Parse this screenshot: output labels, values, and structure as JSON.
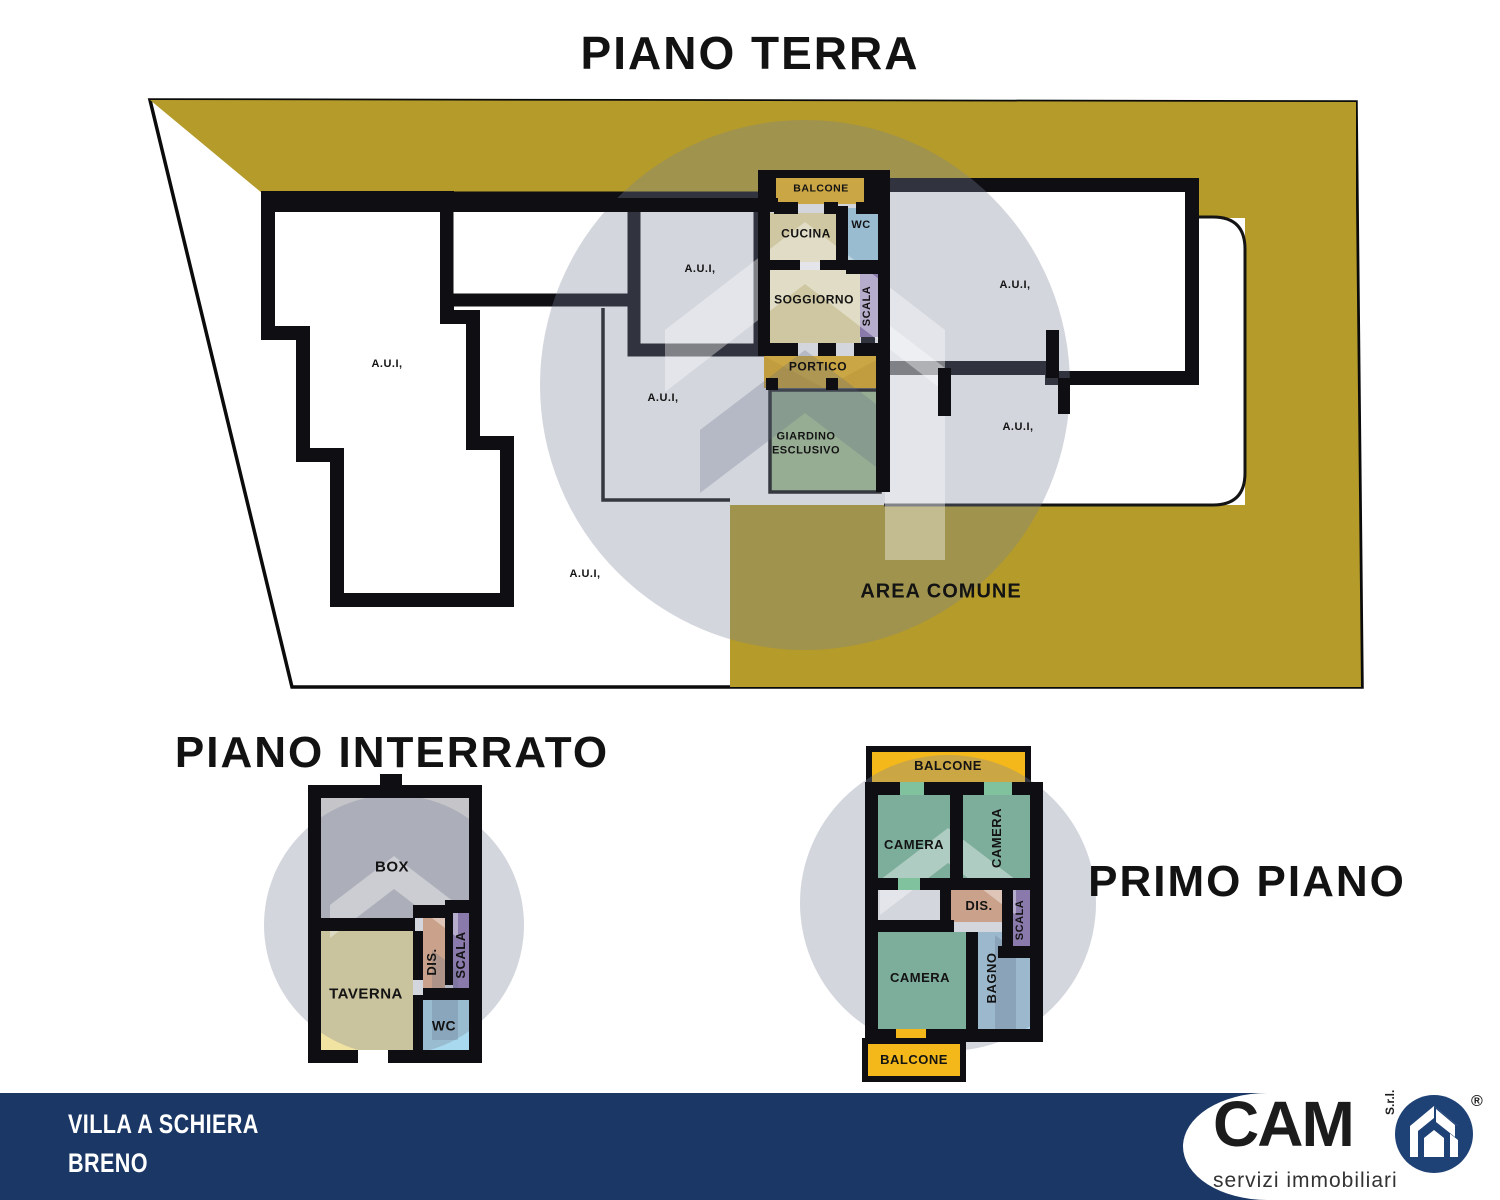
{
  "colors": {
    "gold": "#b49b2a",
    "bright_gold": "#f4b81b",
    "pale_yellow": "#f9e9a7",
    "wc_blue": "#a9d9ee",
    "bagno_blue": "#aed3e8",
    "stair_purple": "#9377b6",
    "garden_green": "#a4c293",
    "camera_green": "#7fc29d",
    "dis_orange": "#f2b285",
    "box_gray": "#c5c5c9",
    "taverna_yellow": "#f1e3a2",
    "wall_black": "#0e0e13",
    "footer_navy": "#1b3765",
    "logo_blue": "#1e4176",
    "watermark_gray": "#7a8399"
  },
  "titles": {
    "ground": "PIANO TERRA",
    "basement": "PIANO INTERRATO",
    "first": "PRIMO PIANO"
  },
  "ground": {
    "labels": {
      "aui": "A.U.I,",
      "balcone": "BALCONE",
      "cucina": "CUCINA",
      "wc": "WC",
      "soggiorno": "SOGGIORNO",
      "scala": "SCALA",
      "portico": "PORTICO",
      "giardino_line1": "GIARDINO",
      "giardino_line2": "ESCLUSIVO",
      "area_comune": "AREA COMUNE"
    }
  },
  "basement": {
    "labels": {
      "box": "BOX",
      "taverna": "TAVERNA",
      "dis": "DIS.",
      "scala": "SCALA",
      "wc": "WC"
    }
  },
  "first": {
    "labels": {
      "balcone_top": "BALCONE",
      "camera_tl": "CAMERA",
      "camera_tr": "CAMERA",
      "camera_bl": "CAMERA",
      "dis": "DIS.",
      "scala": "SCALA",
      "bagno": "BAGNO",
      "balcone_bottom": "BALCONE"
    }
  },
  "footer": {
    "property_line1": "VILLA A SCHIERA",
    "property_line2": "BRENO",
    "brand": "CAM",
    "brand_legal": "S.r.l.",
    "registered": "®",
    "tagline": "servizi immobiliari"
  }
}
